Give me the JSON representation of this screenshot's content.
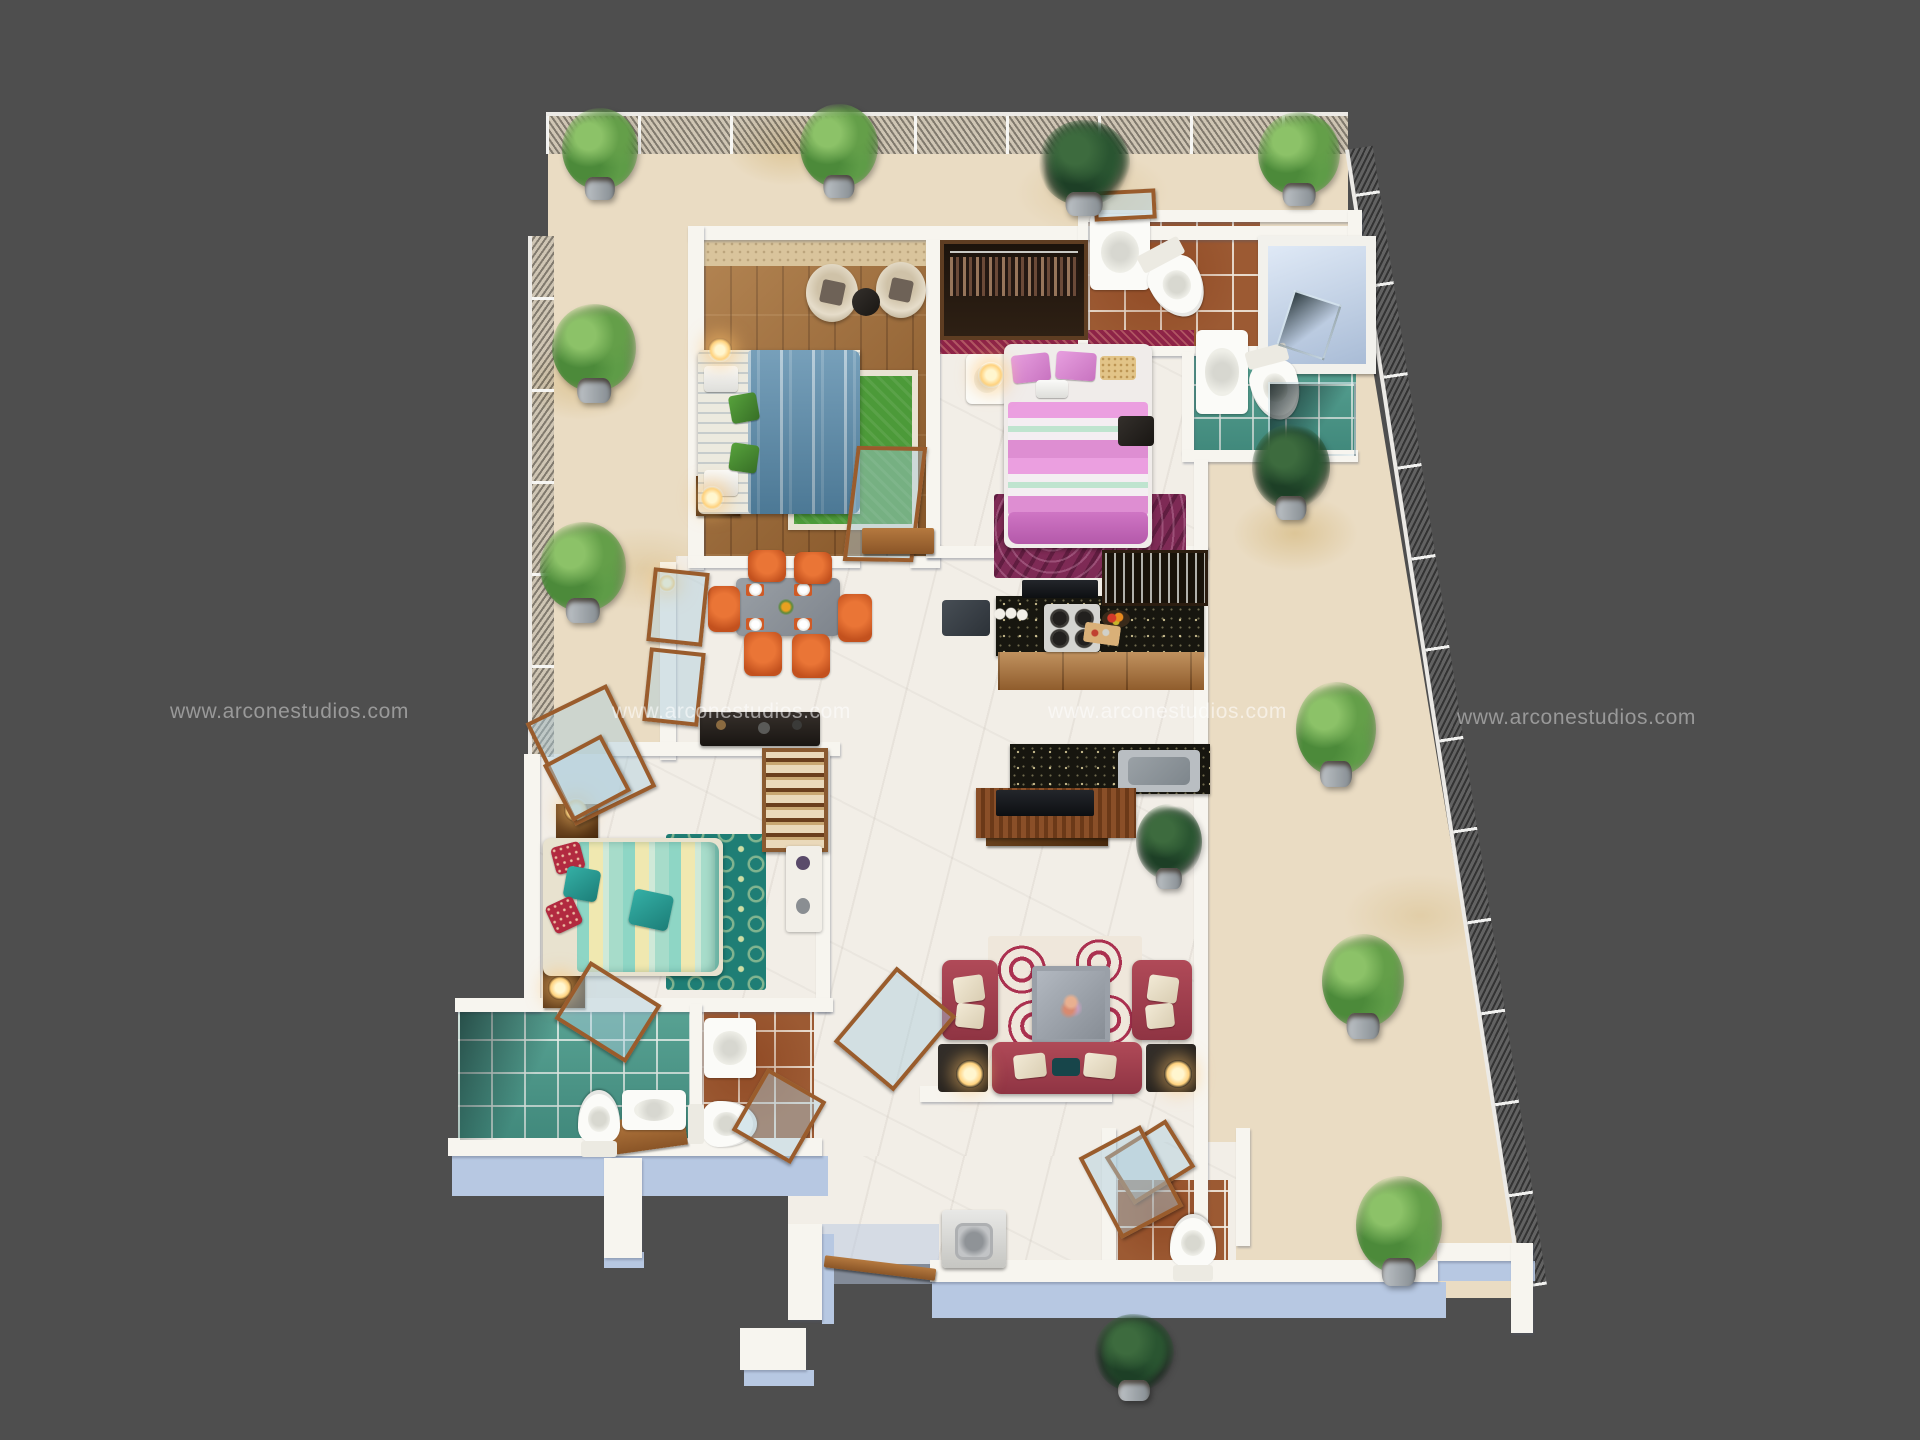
{
  "watermark": {
    "text": "www.arconestudios.com"
  },
  "palette": {
    "bg": "#4e4e4e",
    "wmGray": "#999999",
    "wmLight": "rgba(255,255,255,0.55)",
    "wall": "#f7f5ef",
    "shadowBlue": "#b7c8e2",
    "marble": "#f2eee7",
    "cream": "#eadcc3",
    "woodFloor": "#9a6632",
    "tealTile": "#4f9d8d",
    "brownTile": "#9c5a33",
    "granite": "#17160f",
    "rugGreen": "#4c9a39",
    "rugTeal": "#1f7e75",
    "rugMagenta": "#7e2a55",
    "sofaRed": "#8f3443",
    "chairOrange": "#c3511e",
    "bedBlue": "#5f8fae",
    "bedPink": "#c873c0",
    "plantGreen": "#57923f",
    "plantDark": "#2c5a33",
    "lampGlow": "#ffd27e",
    "doorWood": "#9a5c2c",
    "glassTint": "rgba(170,205,220,0.45)"
  }
}
